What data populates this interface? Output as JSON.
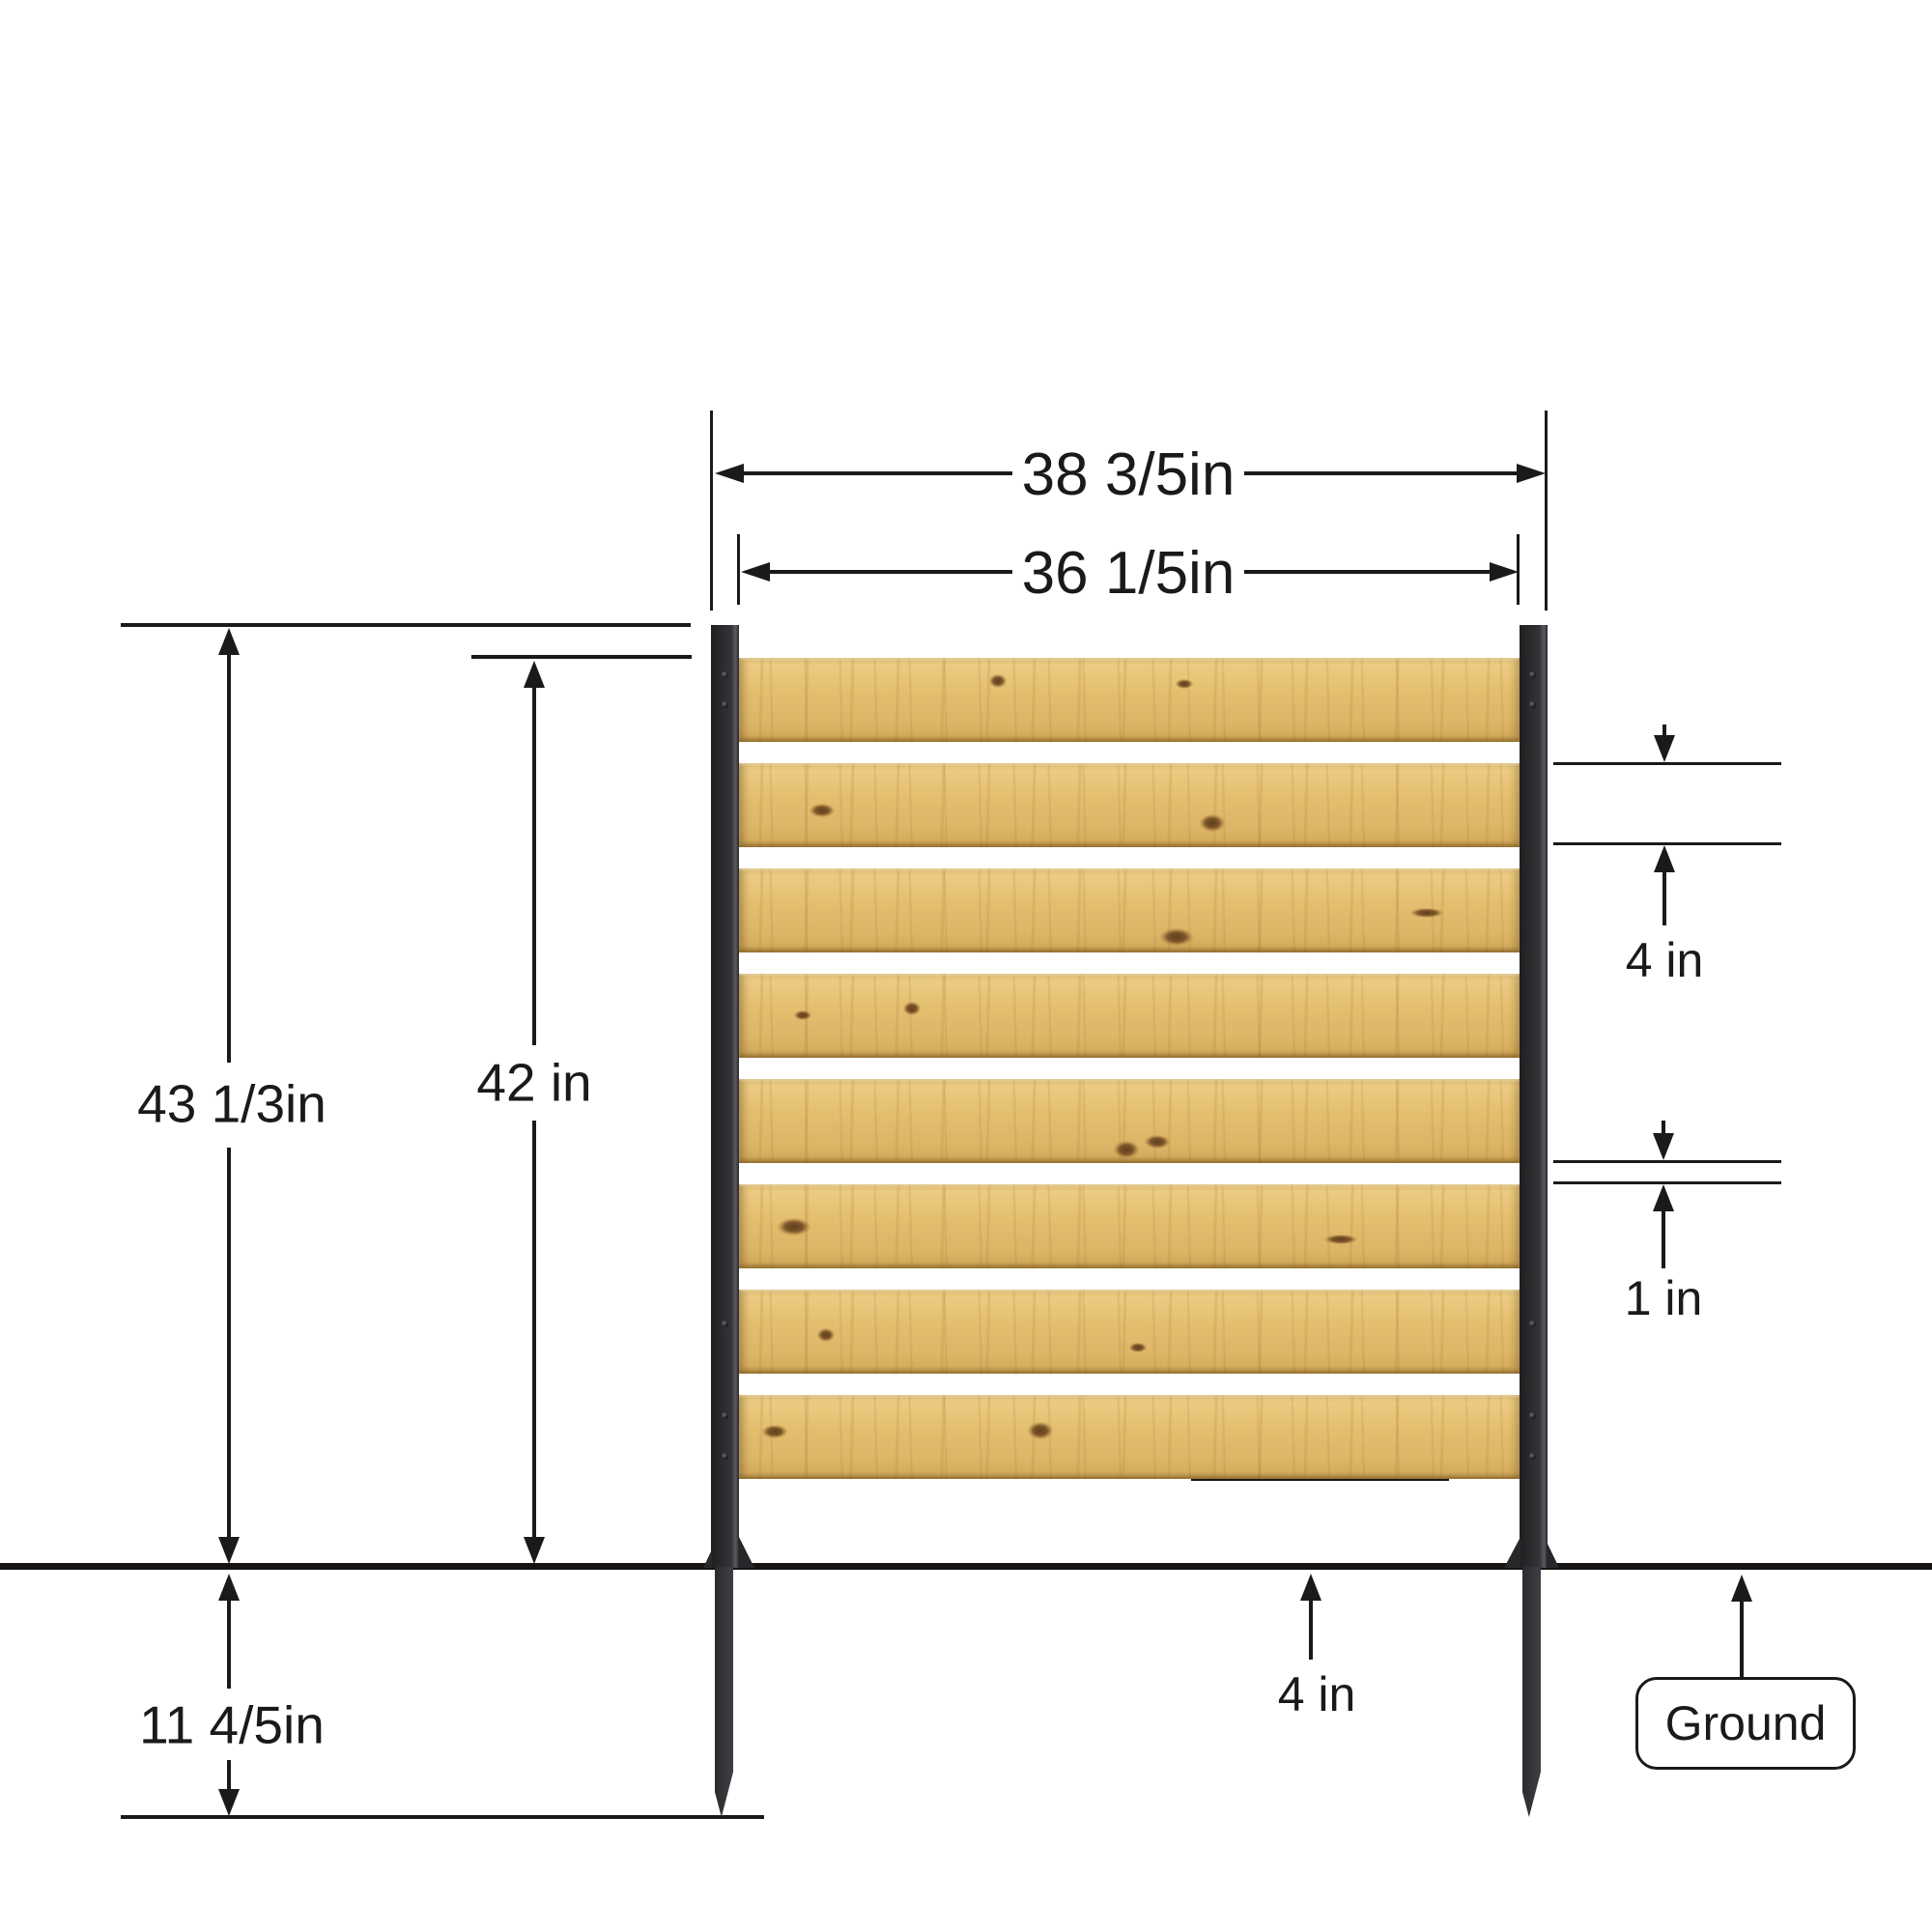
{
  "diagram_title": "fence-panel-dimension-diagram",
  "labels": {
    "outer_width": "38 3/5in",
    "inner_width": "36 1/5in",
    "total_height": "43 1/3in",
    "panel_height": "42 in",
    "slat_width": "4 in",
    "slat_gap": "1 in",
    "ground_clearance": "4 in",
    "buried_depth": "11 4/5in",
    "ground": "Ground"
  },
  "fence": {
    "slat_count": 8,
    "post_count": 2
  },
  "colors": {
    "wood": "#e3bd6e",
    "wood_grain": "#c49a52",
    "knot": "#6b4a1e",
    "post": "#2e2e31",
    "line": "#1a1a1a",
    "background": "#ffffff"
  }
}
